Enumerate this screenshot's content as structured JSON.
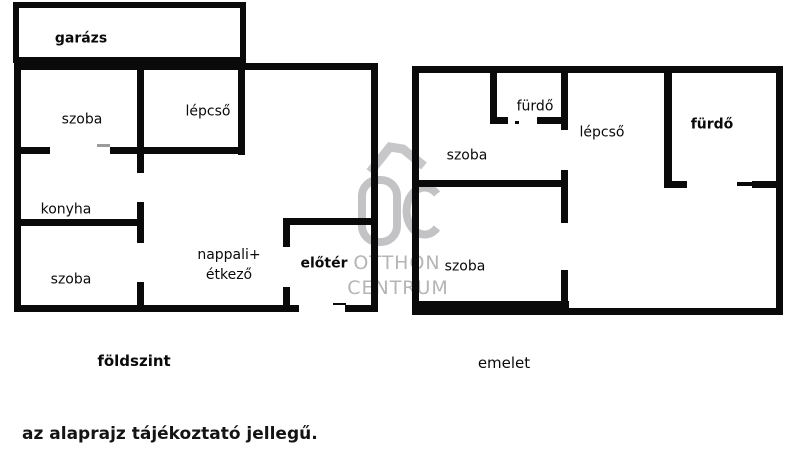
{
  "page": {
    "disclaimer": "az alaprajz tájékoztató jellegű."
  },
  "watermark": {
    "monogram": "OC",
    "line1": "OTTHON",
    "line2": "CENTRUM"
  },
  "colors": {
    "wall": "#0a0a0a",
    "background": "#ffffff",
    "watermark_gray": "#c3c3c5",
    "watermark_text_gray": "#b5b5b7"
  },
  "ground_floor": {
    "label": "földszint",
    "rooms": {
      "garage": "garázs",
      "bedroom_top": "szoba",
      "stairs": "lépcső",
      "kitchen": "konyha",
      "bedroom_bottom": "szoba",
      "living_line1": "nappali+",
      "living_line2": "étkező",
      "foyer": "előtér"
    }
  },
  "upper_floor": {
    "label": "emelet",
    "rooms": {
      "bedroom_top": "szoba",
      "bathroom_small": "fürdő",
      "stairs": "lépcső",
      "bathroom_large": "fürdő",
      "bedroom_bottom": "szoba"
    }
  }
}
